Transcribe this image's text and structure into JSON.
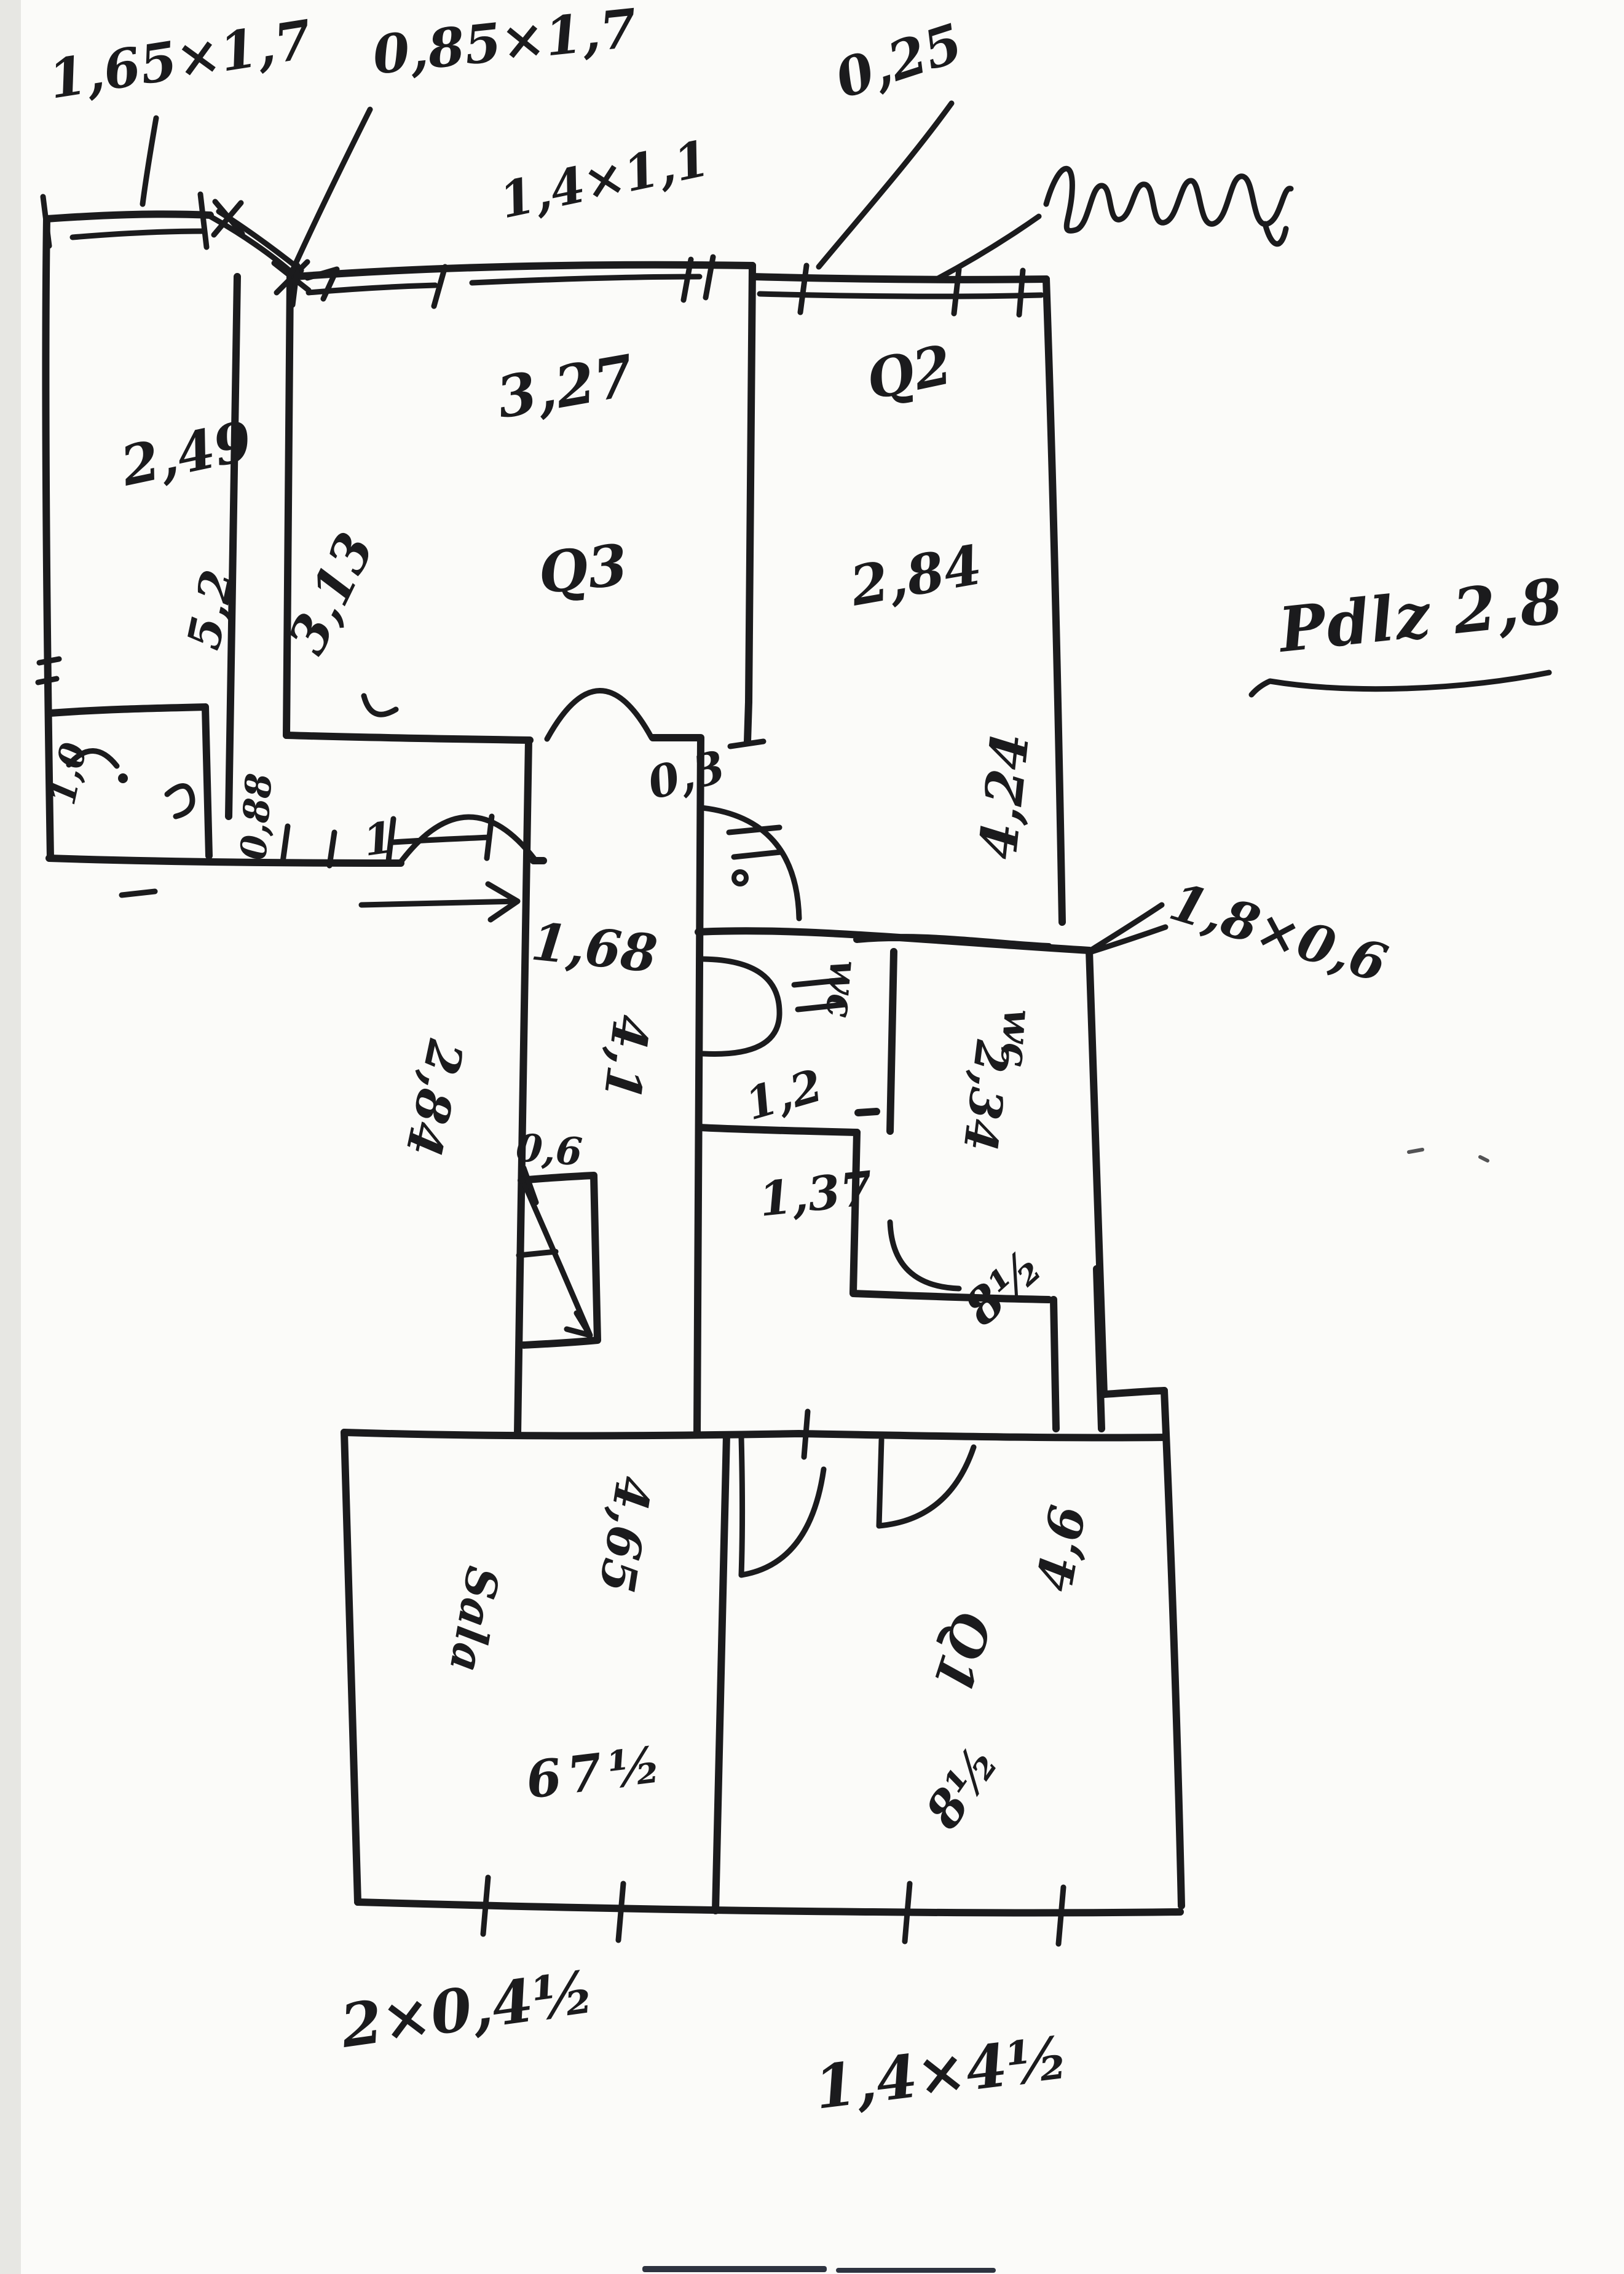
{
  "colors": {
    "ink": "#1b1b1d",
    "paper": "#fbfbf9",
    "scan_edge": "#e7e7e3",
    "scan_mark": "#2e3340"
  },
  "labels": {
    "win_a": "1,65×1,7",
    "win_b": "0,85×1,7",
    "win_c": "1,4×1,1",
    "dim_025": "0,25",
    "room3_width": "3,27",
    "room3_name": "Q3",
    "room3_height": "3,13",
    "room2_name": "Q2",
    "room2_width": "2,84",
    "room2_height": "4,24",
    "roomA_width": "2,49",
    "roomA_height": "5,2",
    "note_right": "Pdlz 2,8",
    "dim_03": "0,3",
    "wardrobe": "1,8×0,6",
    "hall_width": "1,68",
    "hall_height": "4,1",
    "hall_left": "2,84",
    "dim_06": "0,6",
    "dim_088": "0,88",
    "closet": "1,0",
    "door_one": "1",
    "wc1_name": "wc",
    "wc1_width": "1,2",
    "wc1_len": "1,37",
    "wc2_name": "wc",
    "wc2_height": "2,34",
    "wc2_dim": "8½",
    "sala_name": "Sala",
    "sala_width": "4,65",
    "sala_dim": "67½",
    "room1_name": "Q1",
    "room1_height": "4,6",
    "room1_dim": "8½",
    "bottom_left": "2×0,4½",
    "bottom_right": "1,4×4½"
  }
}
